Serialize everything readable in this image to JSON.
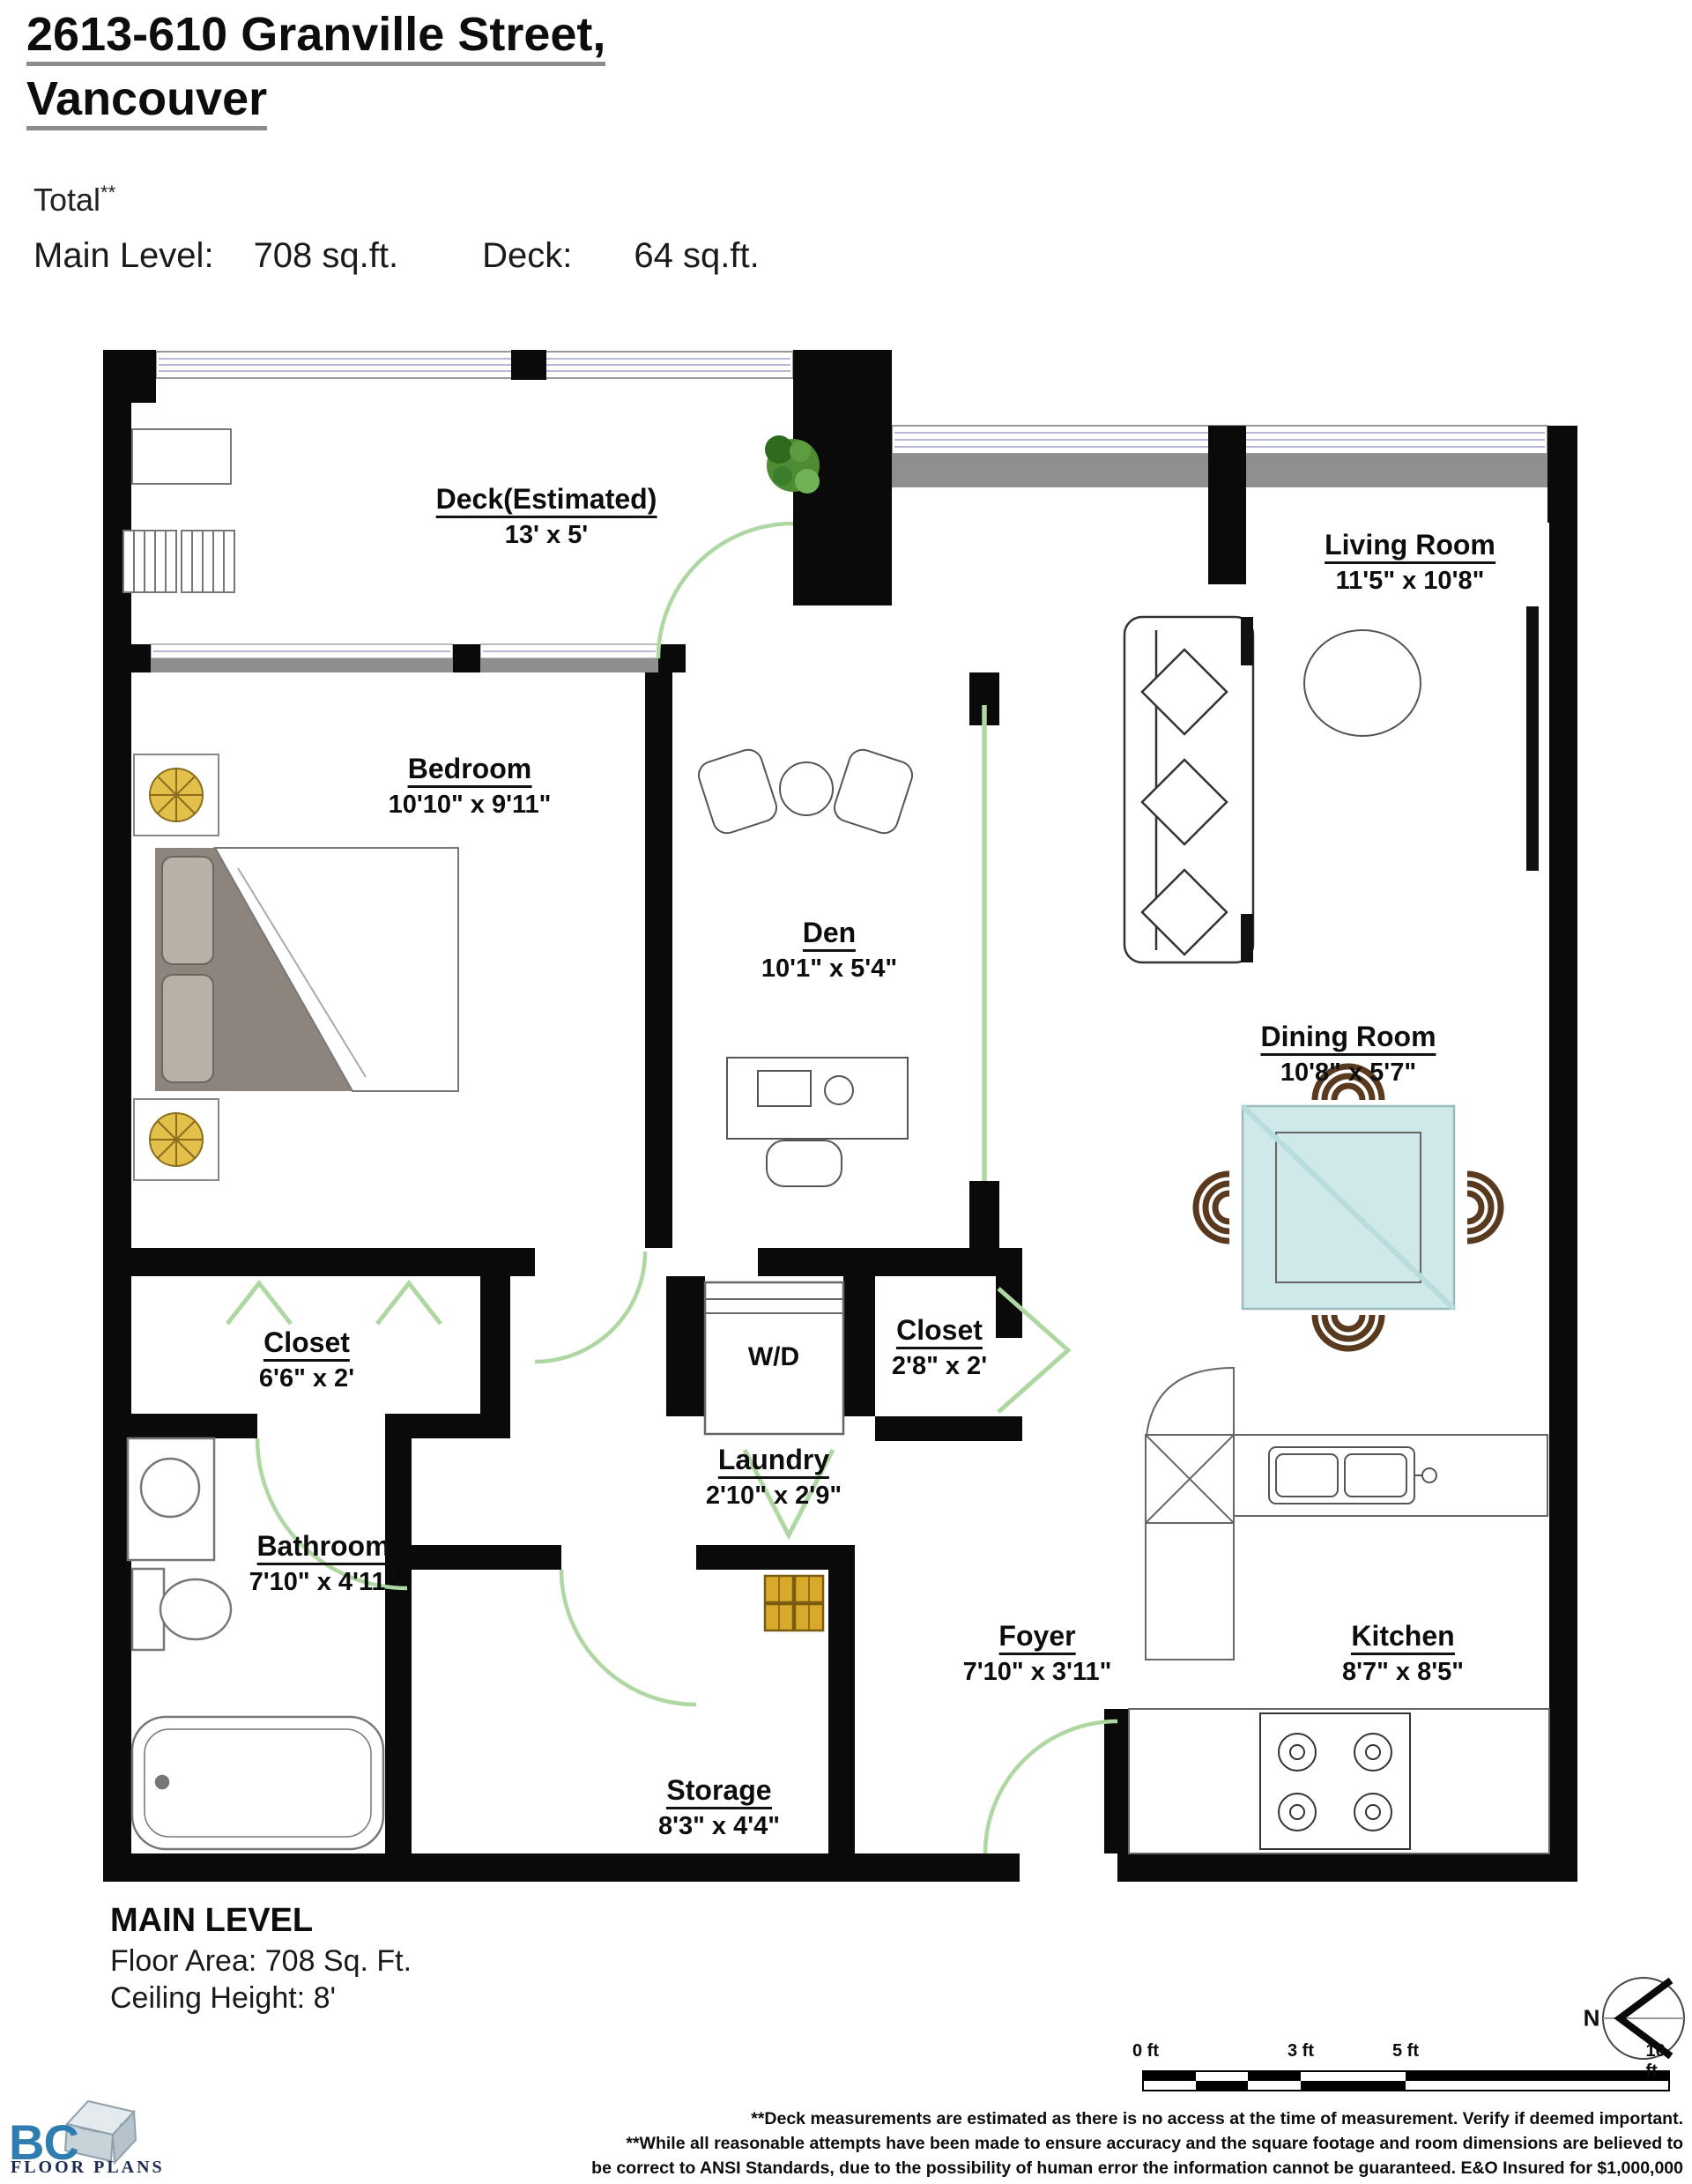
{
  "header": {
    "title_line1": "2613-610 Granville Street,",
    "title_line2": "Vancouver",
    "total_label": "Total",
    "total_sup": "**",
    "main_level_label": "Main Level:",
    "main_level_value": "708 sq.ft.",
    "deck_label": "Deck:",
    "deck_value": "64 sq.ft."
  },
  "rooms": [
    {
      "name": "Deck(Estimated)",
      "dims": "13' x 5'"
    },
    {
      "name": "Living Room",
      "dims": "11'5\" x 10'8\""
    },
    {
      "name": "Bedroom",
      "dims": "10'10\" x 9'11\""
    },
    {
      "name": "Den",
      "dims": "10'1\" x 5'4\""
    },
    {
      "name": "Dining Room",
      "dims": "10'8\" x 5'7\""
    },
    {
      "name": "Closet",
      "dims": "6'6\" x 2'"
    },
    {
      "name": "Closet",
      "dims": "2'8\" x 2'"
    },
    {
      "name": "Laundry",
      "dims": "2'10\" x 2'9\""
    },
    {
      "name": "Bathroom",
      "dims": "7'10\" x 4'11\""
    },
    {
      "name": "Foyer",
      "dims": "7'10\" x 3'11\""
    },
    {
      "name": "Kitchen",
      "dims": "8'7\" x 8'5\""
    },
    {
      "name": "Storage",
      "dims": "8'3\" x 4'4\""
    }
  ],
  "appliances": {
    "washer_dryer": "W/D"
  },
  "footer": {
    "level_title": "MAIN LEVEL",
    "floor_area": "Floor Area: 708 Sq. Ft.",
    "ceiling_height": "Ceiling Height: 8'",
    "scale_ticks": [
      "0 ft",
      "3 ft",
      "5 ft",
      "10 ft"
    ],
    "compass_label": "N",
    "logo_bc": "BC",
    "logo_floor_plans": "FLOOR PLANS",
    "disclaimer_line1": "**Deck measurements are estimated as there is no access at the time of measurement. Verify if deemed important.",
    "disclaimer_line2": "**While all reasonable attempts have been made to ensure accuracy and the square footage and room dimensions are believed to",
    "disclaimer_line3": "be correct to ANSI Standards, due to the possibility of human error the information cannot be guaranteed. E&O Insured for $1,000,000"
  },
  "colors": {
    "wall": "#0a0a0a",
    "door_green": "#aed7a2",
    "window_line": "#9aa2c8",
    "exterior_band_gray": "#8f8f8f",
    "glass_table": "#cfe9ea",
    "chair_brown": "#5a3a1e",
    "bed_gray": "#8d857d",
    "lamp_gold": "#e3c04a",
    "box_gold": "#d9a92c",
    "logo_blue": "#2e7cb0",
    "logo_navy": "#1b2a50"
  }
}
